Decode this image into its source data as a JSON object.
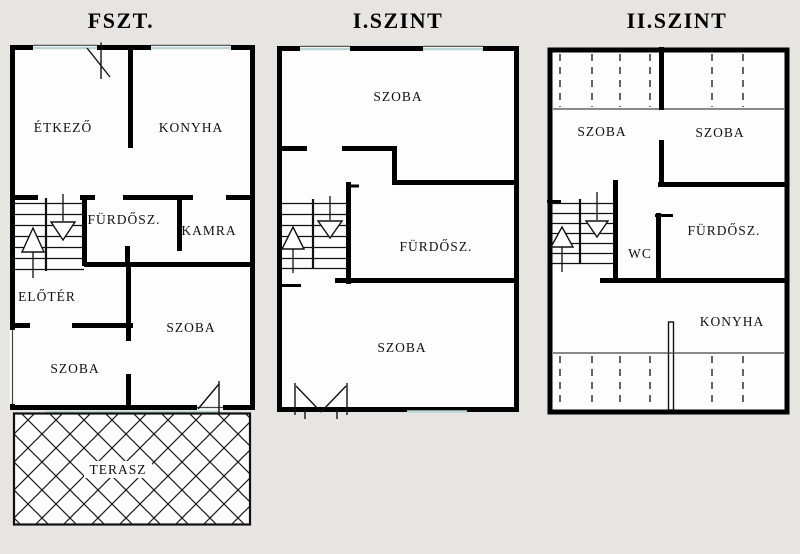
{
  "page": {
    "colors": {
      "background": "#e7e5e2",
      "wall": "#000000",
      "window": "#b7d6d4",
      "floor": "#fdfdfd"
    }
  },
  "floor_plans": [
    {
      "title": "FSZT.",
      "labels": {
        "etkezo": "ÉTKEZŐ",
        "konyha": "KONYHA",
        "furdosz": "FÜRDŐSZ.",
        "kamra": "KAMRA",
        "eloter": "ELŐTÉR",
        "szoba_right": "SZOBA",
        "szoba_left": "SZOBA",
        "terasz": "TERASZ"
      }
    },
    {
      "title": "I.SZINT",
      "labels": {
        "szoba_top": "SZOBA",
        "furdosz": "FÜRDŐSZ.",
        "szoba_bottom": "SZOBA"
      }
    },
    {
      "title": "II.SZINT",
      "labels": {
        "szoba_left": "SZOBA",
        "szoba_right": "SZOBA",
        "wc": "WC",
        "furdosz": "FÜRDŐSZ.",
        "konyha": "KONYHA"
      }
    }
  ]
}
